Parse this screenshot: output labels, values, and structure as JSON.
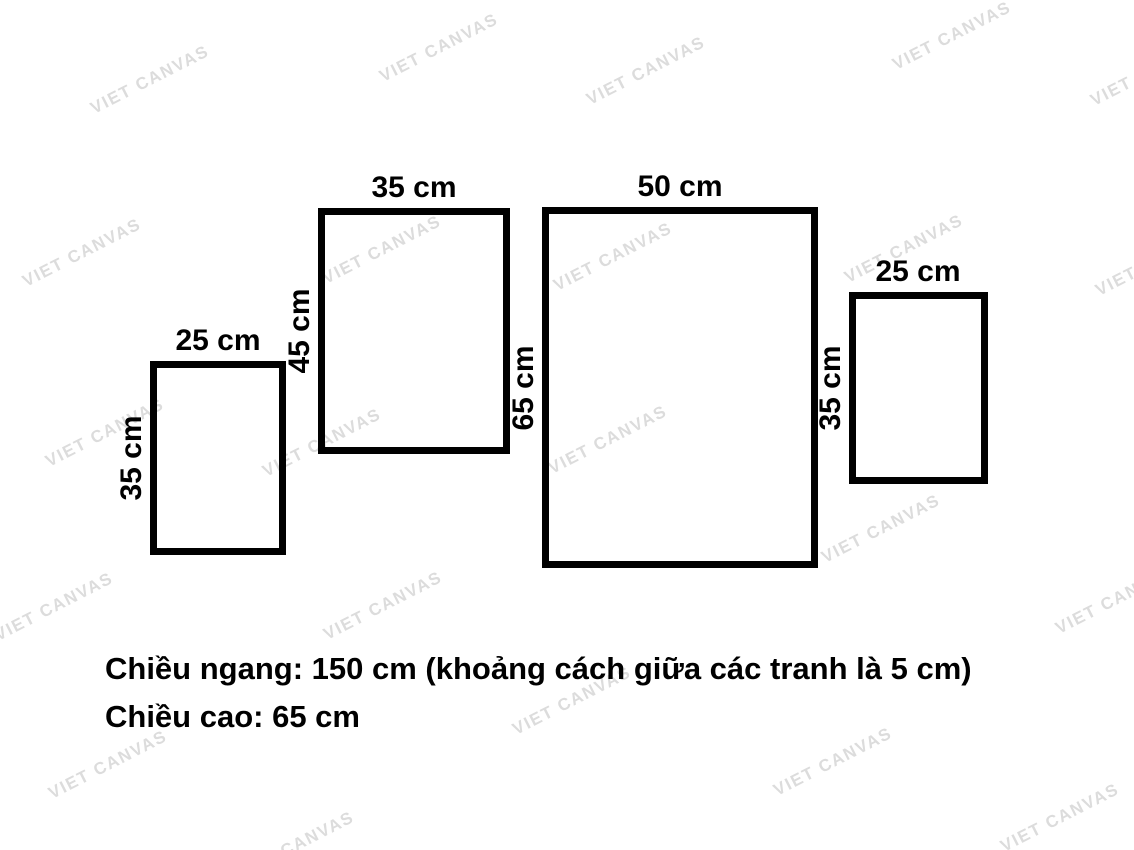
{
  "watermark": {
    "text": "VIET CANVAS",
    "color": "#dcdcdc"
  },
  "frames": [
    {
      "width_label": "25 cm",
      "height_label": "35 cm",
      "width_cm": 25,
      "height_cm": 35
    },
    {
      "width_label": "35 cm",
      "height_label": "45 cm",
      "width_cm": 35,
      "height_cm": 45
    },
    {
      "width_label": "50 cm",
      "height_label": "65 cm",
      "width_cm": 50,
      "height_cm": 65
    },
    {
      "width_label": "25 cm",
      "height_label": "35 cm",
      "width_cm": 25,
      "height_cm": 35
    }
  ],
  "caption": {
    "line1": "Chiều ngang: 150 cm (khoảng cách giữa các tranh là 5 cm)",
    "line2": "Chiều cao: 65 cm"
  },
  "set_dimensions": {
    "total_width_cm": 150,
    "gap_between_pieces_cm": 5,
    "total_height_cm": 65
  },
  "colors": {
    "background": "#ffffff",
    "frame_border": "#000000",
    "text": "#000000",
    "watermark": "#dcdcdc"
  }
}
